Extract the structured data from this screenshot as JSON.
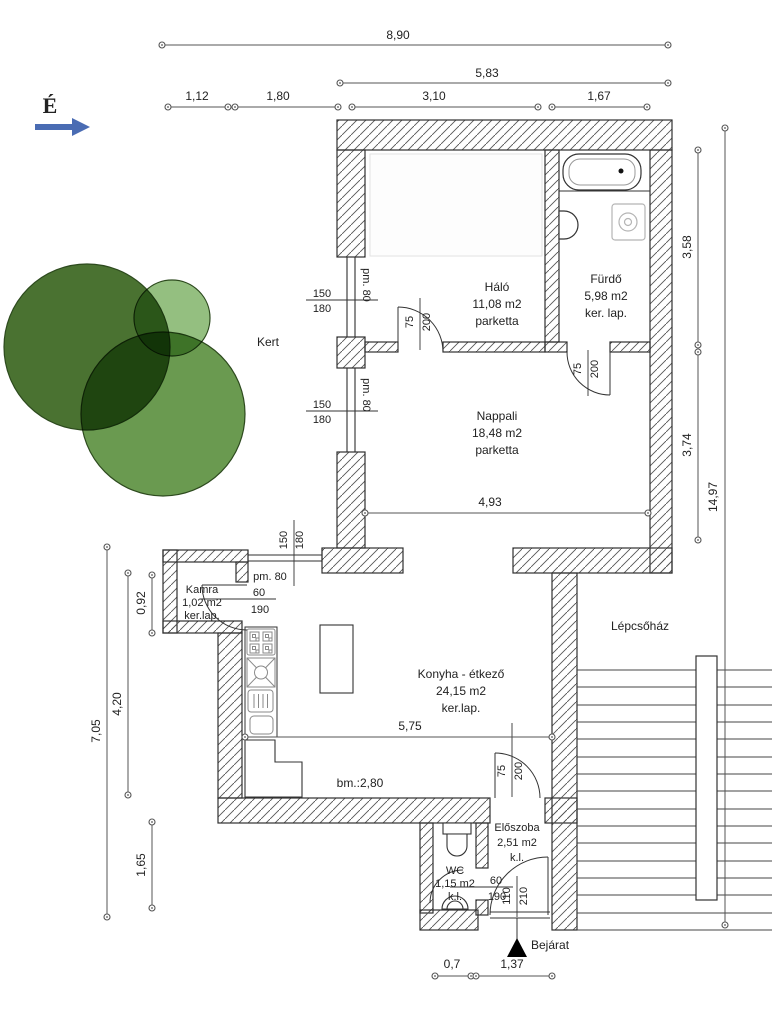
{
  "compass": {
    "north_label": "É"
  },
  "site": {
    "garden_label": "Kert",
    "staircase_label": "Lépcsőház",
    "entrance_label": "Bejárat"
  },
  "rooms": {
    "halo": {
      "name": "Háló",
      "area": "11,08 m2",
      "floor": "parketta"
    },
    "furdo": {
      "name": "Fürdő",
      "area": "5,98 m2",
      "floor": "ker. lap."
    },
    "nappali": {
      "name": "Nappali",
      "area": "18,48 m2",
      "floor": "parketta"
    },
    "kamra": {
      "name": "Kamra",
      "area": "1,02 m2",
      "floor": "ker.lap."
    },
    "konyha": {
      "name": "Konyha - étkező",
      "area": "24,15 m2",
      "floor": "ker.lap."
    },
    "eloszoba": {
      "name": "Előszoba",
      "area": "2,51 m2",
      "floor": "k.l."
    },
    "wc": {
      "name": "WC",
      "area": "1,15 m2",
      "floor": "k.l."
    }
  },
  "dimensions": {
    "top": {
      "total": "8,90",
      "wing": "5,83",
      "seg1": "1,12",
      "seg2": "1,80",
      "seg3": "3,10",
      "seg4": "1,67"
    },
    "right": {
      "furdo_depth": "3,58",
      "nappali_depth": "3,74",
      "total": "14,97"
    },
    "left": {
      "total": "7,05",
      "konyha_depth": "4,20",
      "kamra_depth": "0,92",
      "wc_depth": "1,65"
    },
    "bottom": {
      "seg1": "0,7",
      "seg2": "1,37"
    },
    "interior": {
      "nappali_width": "4,93",
      "konyha_width": "5,75",
      "konyha_note": "bm.:2,80"
    }
  },
  "openings": {
    "window_w": "150",
    "window_h": "180",
    "window_sill": "pm. 80",
    "door75_w": "75",
    "door75_h": "200",
    "door60_w": "60",
    "door60_h": "190",
    "entry_w": "110",
    "entry_h": "210"
  },
  "colors": {
    "tree_dark": "#4a7231",
    "tree_light": "#94bf80",
    "tree_mid": "#6a9a50",
    "compass_blue": "#4a6cb3",
    "wall_line": "#2f2f2f"
  }
}
